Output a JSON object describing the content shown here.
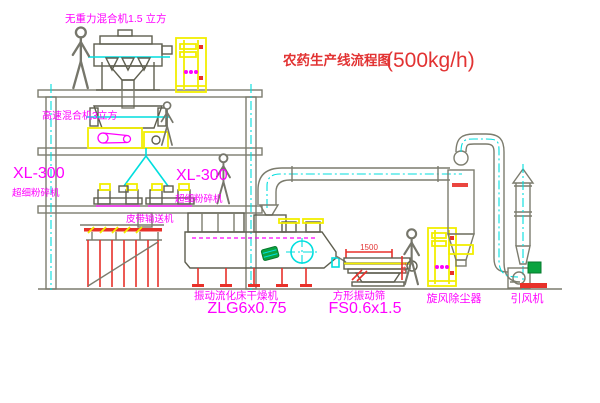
{
  "diagram": {
    "title_cn": "农药生产线流程图",
    "title_capacity": "(500kg/h)",
    "equipment": {
      "top_mixer": "无重力混合机1.5 立方",
      "high_speed_mixer": "高速混合机3立方",
      "pulverizer_left_model": "XL-300",
      "pulverizer_left_name": "超细粉碎机",
      "pulverizer_mid_model": "XL-300",
      "pulverizer_mid_name": "超细粉碎机",
      "belt_conveyor": "皮带输送机",
      "dryer_name": "振动流化床干燥机",
      "dryer_model": "ZLG6x0.75",
      "sieve_name": "方形振动筛",
      "sieve_model": "FS0.6x1.5",
      "cyclone_name": "旋风除尘器",
      "fan_name": "引风机"
    },
    "dimensions": {
      "sieve_length": "1500",
      "sieve_height": "541"
    },
    "colors": {
      "label_magenta": "#ff00ff",
      "title_red": "#e23333",
      "machine_yellow": "#f2ee00",
      "flow_cyan": "#00dede",
      "structure_gray": "#7c7c6e",
      "accent_red": "#e8312a",
      "motor_green": "#0aa33f"
    }
  }
}
